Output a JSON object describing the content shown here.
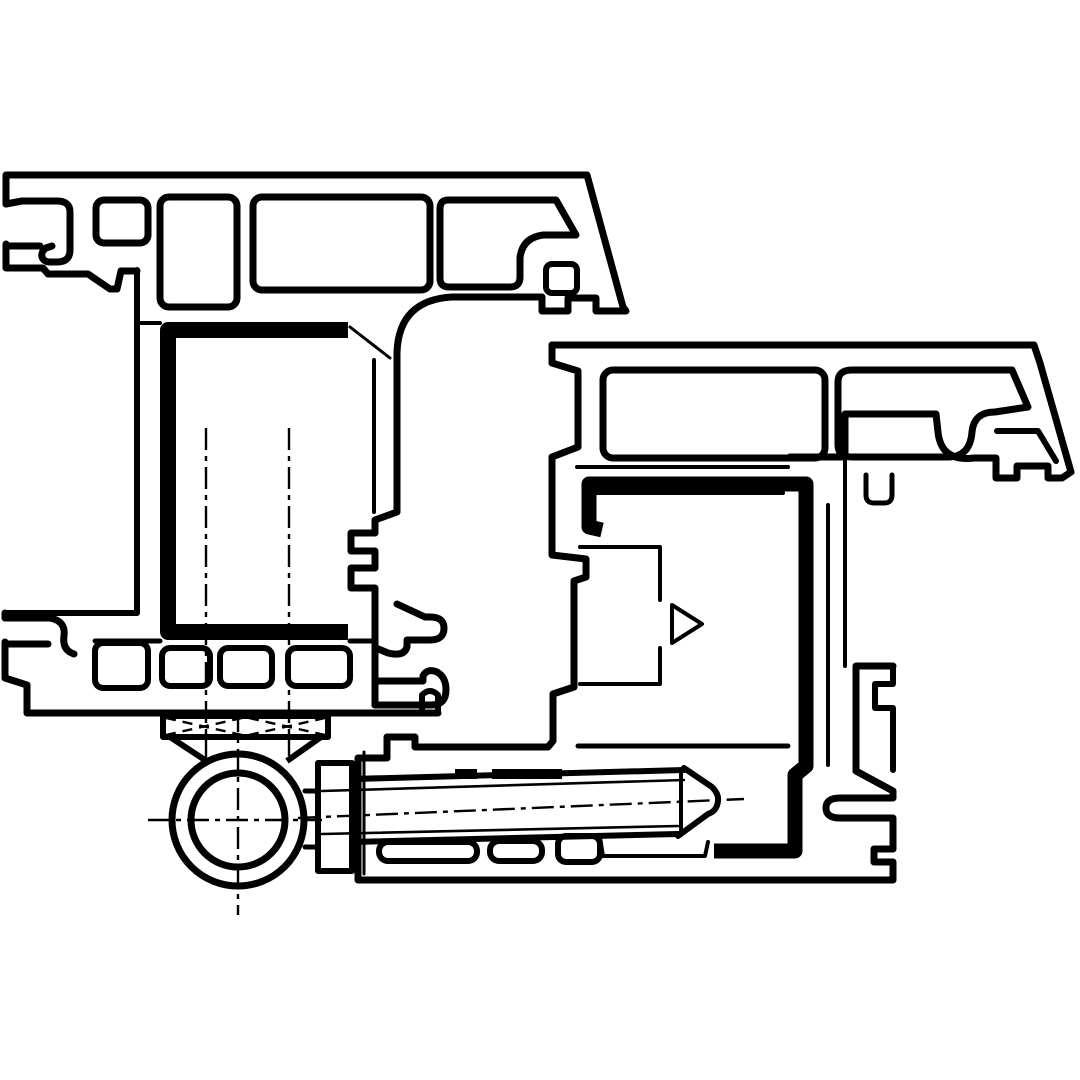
{
  "meta": {
    "title": "",
    "description": "Technical line drawing: horizontal cross-section of a door hinge (roller hinge with fixing screw) mounted between a PVC frame profile and a sash profile",
    "drawing_type": "CAD cross-section, black line art on white, no text or dimensions visible"
  },
  "colors": {
    "background": "#ffffff",
    "line": "#000000"
  },
  "line_weights": {
    "outer_contour_px": 7,
    "chamber_wall_px": 6,
    "thin_detail_px": 3,
    "centerline_px": 2.4,
    "seal_gasket_px": 15,
    "steel_channel_px": 16
  },
  "components": {
    "frame_profile": "multi-chamber frame extrusion, upper left",
    "sash_profile": "multi-chamber sash extrusion, lower right",
    "steel_reinforcement": "thick U-channel inside frame center chamber",
    "gasket_seal": "thick black seal channel inside sash",
    "hinge_barrel": "two concentric circles with center cross lines, bottom left",
    "mounting_bracket": "trapezoid plate with X lashing between frame and barrel",
    "fixing_screw": "horizontal tapered screw pin with dash-dot axis",
    "centerlines": "dash-dot construction lines through screw axes and barrel"
  }
}
